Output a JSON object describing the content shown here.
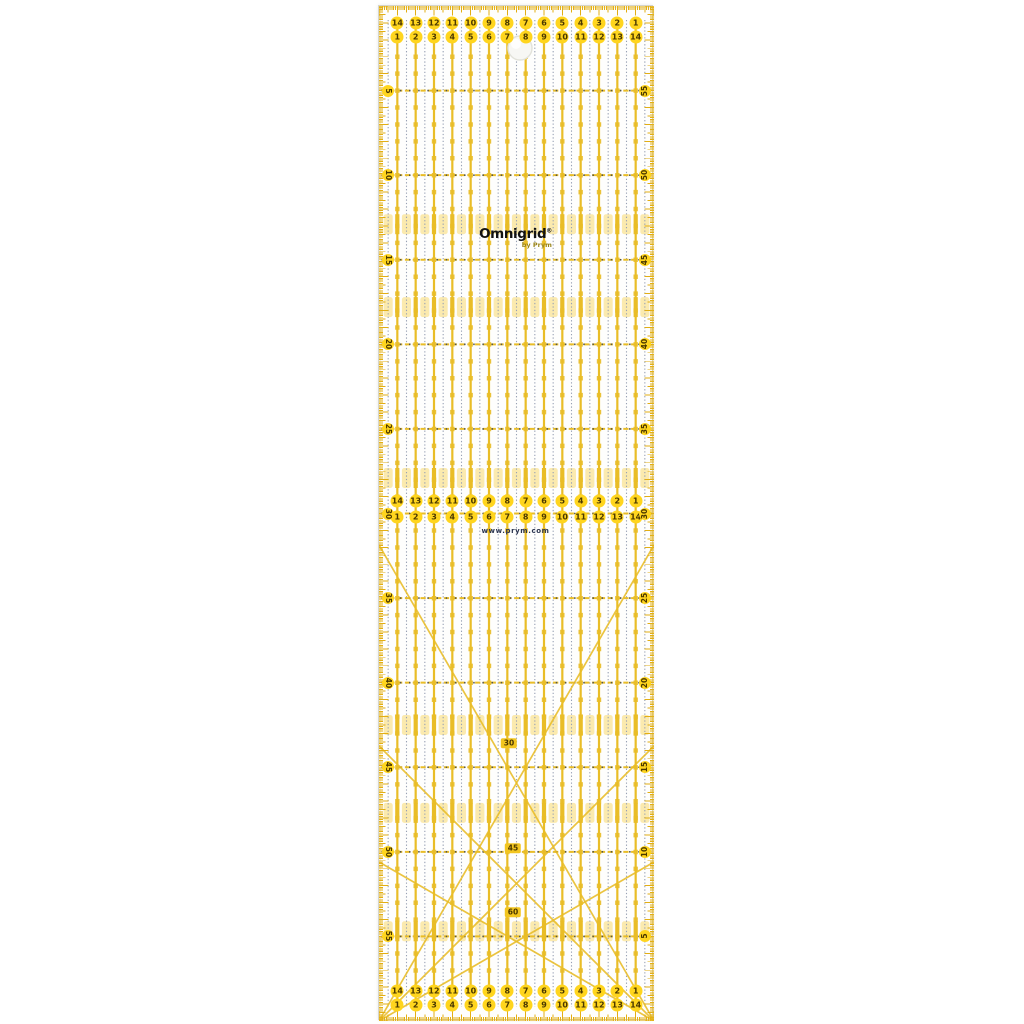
{
  "product": {
    "brand": "Omnigrid",
    "trademark": "®",
    "byline": "by Prym",
    "website": "www.prym.com"
  },
  "ruler": {
    "width_cm": 15,
    "length_cm": 60,
    "scales": {
      "top": {
        "row1": [
          14,
          13,
          12,
          11,
          10,
          9,
          8,
          7,
          6,
          5,
          4,
          3,
          2,
          1
        ],
        "row2": [
          1,
          2,
          3,
          4,
          5,
          6,
          7,
          8,
          9,
          10,
          11,
          12,
          13,
          14
        ]
      },
      "middle": {
        "row1": [
          14,
          13,
          12,
          11,
          10,
          9,
          8,
          7,
          6,
          5,
          4,
          3,
          2,
          1
        ],
        "row2": [
          1,
          2,
          3,
          4,
          5,
          6,
          7,
          8,
          9,
          10,
          11,
          12,
          13,
          14
        ]
      },
      "bottom": {
        "row1": [
          14,
          13,
          12,
          11,
          10,
          9,
          8,
          7,
          6,
          5,
          4,
          3,
          2,
          1
        ],
        "row2": [
          1,
          2,
          3,
          4,
          5,
          6,
          7,
          8,
          9,
          10,
          11,
          12,
          13,
          14
        ]
      }
    },
    "edges": {
      "left": [
        5,
        10,
        15,
        20,
        25,
        30,
        35,
        40,
        45,
        50,
        55
      ],
      "right": [
        55,
        50,
        45,
        40,
        35,
        30,
        25,
        20,
        15,
        10,
        5
      ]
    },
    "angle_labels": [
      "30",
      "45",
      "60"
    ],
    "highlight_band_centers_cm": [
      12.9,
      17.8,
      27.9,
      42.5,
      47.7,
      54.7
    ],
    "colors": {
      "grid_yellow": "#E9BD27",
      "tick_yellow": "#E2AE14",
      "band_yellow": "#F8D96E",
      "circle_fill": "#FFD51E",
      "number_text": "#4A3800",
      "dot_blue_gray": "#98A1B4",
      "dash_dot_dark": "#55554A",
      "logo_black": "#121212",
      "byline_olive": "#9A8418",
      "url_navy": "#2B3550",
      "ruler_edge": "#D5D5CC"
    }
  }
}
